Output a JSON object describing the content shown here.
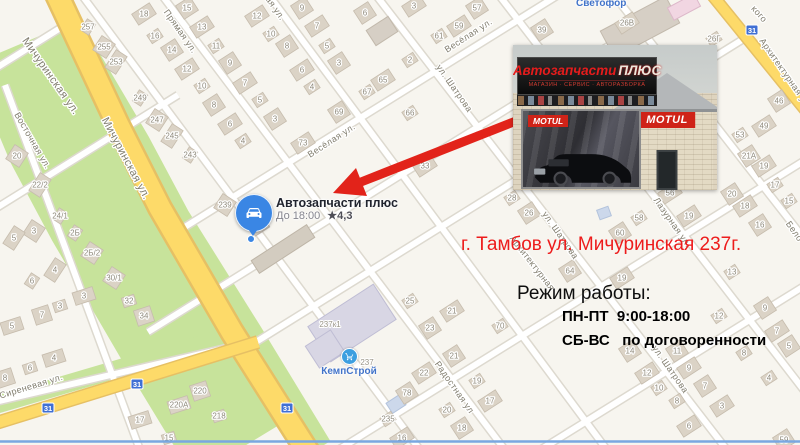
{
  "map": {
    "pin": {
      "title": "Автозапчасти плюс",
      "hours": "До 18:00",
      "rating": "★4,3"
    },
    "poi": {
      "svetofor": "Светофор",
      "kempstroy": "КемпСтрой"
    },
    "colors": {
      "road_yellow": "#fdda69",
      "green": "#c7e39b",
      "accent_red": "#e2231a",
      "poi_blue": "#4173c9",
      "pin_blue": "#3a86e4"
    },
    "street_labels": [
      {
        "t": "Мичуринская ул.",
        "x": 48,
        "y": 78,
        "r": 55,
        "s": 11
      },
      {
        "t": "Мичуринская ул.",
        "x": 123,
        "y": 160,
        "r": 62,
        "s": 11
      },
      {
        "t": "Восточная ул.",
        "x": 30,
        "y": 142,
        "r": 60,
        "s": 9
      },
      {
        "t": "Прямая ул.",
        "x": 178,
        "y": 33,
        "r": 55,
        "s": 9
      },
      {
        "t": "ая ул.",
        "x": 273,
        "y": 10,
        "r": 55,
        "s": 9
      },
      {
        "t": "Весёлая ул.",
        "x": 333,
        "y": 143,
        "r": -33,
        "s": 9
      },
      {
        "t": "Весёлая ул.",
        "x": 470,
        "y": 38,
        "r": -33,
        "s": 9
      },
      {
        "t": "ул. Шатрова",
        "x": 452,
        "y": 90,
        "r": 55,
        "s": 9
      },
      {
        "t": "ул. Шатрова",
        "x": 558,
        "y": 237,
        "r": 55,
        "s": 9
      },
      {
        "t": "ул. Шатрова",
        "x": 668,
        "y": 371,
        "r": 55,
        "s": 9
      },
      {
        "t": "Лазурная ул.",
        "x": 670,
        "y": 224,
        "r": 55,
        "s": 9
      },
      {
        "t": "Радостная ул",
        "x": 452,
        "y": 389,
        "r": 55,
        "s": 9
      },
      {
        "t": "Сиреневая ул.",
        "x": 32,
        "y": 389,
        "r": -17,
        "s": 9
      },
      {
        "t": "Архитектурная ул.",
        "x": 783,
        "y": 75,
        "r": 55,
        "s": 9
      },
      {
        "t": "Архитектурная",
        "x": 530,
        "y": 265,
        "r": 52,
        "s": 9
      },
      {
        "t": "Бело",
        "x": 792,
        "y": 233,
        "r": 55,
        "s": 9
      },
      {
        "t": "кого",
        "x": 757,
        "y": 16,
        "r": 48,
        "s": 9
      }
    ],
    "address_labels": [
      {
        "t": "237к1",
        "x": 330,
        "y": 327
      },
      {
        "t": "237",
        "x": 367,
        "y": 365
      }
    ],
    "route_badges": [
      {
        "t": "31",
        "x": 752,
        "y": 30
      },
      {
        "t": "31",
        "x": 137,
        "y": 384
      },
      {
        "t": "31",
        "x": 48,
        "y": 408
      },
      {
        "t": "31",
        "x": 287,
        "y": 408
      }
    ],
    "house_numbers": [
      {
        "t": "257",
        "x": 88,
        "y": 26,
        "r": -57
      },
      {
        "t": "255",
        "x": 104,
        "y": 46,
        "r": -57
      },
      {
        "t": "253",
        "x": 116,
        "y": 61,
        "r": -57
      },
      {
        "t": "249",
        "x": 140,
        "y": 97,
        "r": -57
      },
      {
        "t": "247",
        "x": 157,
        "y": 119,
        "r": -57
      },
      {
        "t": "245",
        "x": 172,
        "y": 135,
        "r": -57
      },
      {
        "t": "243",
        "x": 190,
        "y": 154,
        "r": -57
      },
      {
        "t": "239",
        "x": 225,
        "y": 204,
        "r": -57
      },
      {
        "t": "18",
        "x": 144,
        "y": 13
      },
      {
        "t": "16",
        "x": 155,
        "y": 35
      },
      {
        "t": "14",
        "x": 172,
        "y": 49
      },
      {
        "t": "12",
        "x": 187,
        "y": 68
      },
      {
        "t": "10",
        "x": 202,
        "y": 85
      },
      {
        "t": "8",
        "x": 214,
        "y": 104
      },
      {
        "t": "6",
        "x": 230,
        "y": 123
      },
      {
        "t": "4",
        "x": 243,
        "y": 140
      },
      {
        "t": "15",
        "x": 187,
        "y": 7
      },
      {
        "t": "13",
        "x": 202,
        "y": 26
      },
      {
        "t": "11",
        "x": 216,
        "y": 45
      },
      {
        "t": "9",
        "x": 230,
        "y": 62
      },
      {
        "t": "7",
        "x": 245,
        "y": 82
      },
      {
        "t": "5",
        "x": 260,
        "y": 99
      },
      {
        "t": "3",
        "x": 275,
        "y": 118
      },
      {
        "t": "12",
        "x": 257,
        "y": 15
      },
      {
        "t": "10",
        "x": 271,
        "y": 33
      },
      {
        "t": "8",
        "x": 287,
        "y": 45
      },
      {
        "t": "6",
        "x": 302,
        "y": 69
      },
      {
        "t": "4",
        "x": 312,
        "y": 86
      },
      {
        "t": "9",
        "x": 302,
        "y": 7
      },
      {
        "t": "7",
        "x": 317,
        "y": 25
      },
      {
        "t": "5",
        "x": 327,
        "y": 45
      },
      {
        "t": "3",
        "x": 339,
        "y": 62
      },
      {
        "t": "3",
        "x": 414,
        "y": 5
      },
      {
        "t": "2",
        "x": 410,
        "y": 59
      },
      {
        "t": "6",
        "x": 365,
        "y": 12
      },
      {
        "t": "65",
        "x": 383,
        "y": 79
      },
      {
        "t": "67",
        "x": 367,
        "y": 91
      },
      {
        "t": "69",
        "x": 339,
        "y": 111
      },
      {
        "t": "73",
        "x": 303,
        "y": 142
      },
      {
        "t": "66",
        "x": 410,
        "y": 112
      },
      {
        "t": "57",
        "x": 477,
        "y": 7
      },
      {
        "t": "59",
        "x": 459,
        "y": 25
      },
      {
        "t": "61",
        "x": 439,
        "y": 35
      },
      {
        "t": "39",
        "x": 542,
        "y": 29
      },
      {
        "t": "33",
        "x": 425,
        "y": 165
      },
      {
        "t": "28",
        "x": 512,
        "y": 197
      },
      {
        "t": "26",
        "x": 529,
        "y": 212
      },
      {
        "t": "26В",
        "x": 627,
        "y": 22
      },
      {
        "t": "26Г",
        "x": 714,
        "y": 38
      },
      {
        "t": "46",
        "x": 779,
        "y": 100
      },
      {
        "t": "49",
        "x": 764,
        "y": 125
      },
      {
        "t": "53",
        "x": 740,
        "y": 134
      },
      {
        "t": "21А",
        "x": 749,
        "y": 155
      },
      {
        "t": "19",
        "x": 764,
        "y": 165
      },
      {
        "t": "17",
        "x": 775,
        "y": 184
      },
      {
        "t": "20",
        "x": 732,
        "y": 193
      },
      {
        "t": "56",
        "x": 670,
        "y": 192
      },
      {
        "t": "58",
        "x": 639,
        "y": 217
      },
      {
        "t": "60",
        "x": 620,
        "y": 232
      },
      {
        "t": "18",
        "x": 745,
        "y": 205
      },
      {
        "t": "15",
        "x": 789,
        "y": 200
      },
      {
        "t": "16",
        "x": 760,
        "y": 224
      },
      {
        "t": "19",
        "x": 689,
        "y": 215
      },
      {
        "t": "13",
        "x": 732,
        "y": 271
      },
      {
        "t": "64",
        "x": 570,
        "y": 270
      },
      {
        "t": "19",
        "x": 622,
        "y": 277
      },
      {
        "t": "25",
        "x": 410,
        "y": 300
      },
      {
        "t": "23",
        "x": 430,
        "y": 327
      },
      {
        "t": "21",
        "x": 452,
        "y": 310
      },
      {
        "t": "70",
        "x": 500,
        "y": 325
      },
      {
        "t": "21",
        "x": 454,
        "y": 355
      },
      {
        "t": "22",
        "x": 424,
        "y": 372
      },
      {
        "t": "19",
        "x": 477,
        "y": 380
      },
      {
        "t": "78",
        "x": 407,
        "y": 392
      },
      {
        "t": "17",
        "x": 490,
        "y": 400
      },
      {
        "t": "20",
        "x": 447,
        "y": 409
      },
      {
        "t": "18",
        "x": 462,
        "y": 427
      },
      {
        "t": "16",
        "x": 402,
        "y": 437
      },
      {
        "t": "235",
        "x": 388,
        "y": 418
      },
      {
        "t": "14",
        "x": 630,
        "y": 350
      },
      {
        "t": "12",
        "x": 647,
        "y": 372
      },
      {
        "t": "10",
        "x": 659,
        "y": 387
      },
      {
        "t": "11",
        "x": 677,
        "y": 350
      },
      {
        "t": "9",
        "x": 689,
        "y": 367
      },
      {
        "t": "8",
        "x": 677,
        "y": 400
      },
      {
        "t": "7",
        "x": 705,
        "y": 385
      },
      {
        "t": "6",
        "x": 689,
        "y": 425
      },
      {
        "t": "12",
        "x": 719,
        "y": 315
      },
      {
        "t": "9",
        "x": 765,
        "y": 307
      },
      {
        "t": "7",
        "x": 777,
        "y": 330
      },
      {
        "t": "8",
        "x": 744,
        "y": 352
      },
      {
        "t": "5",
        "x": 789,
        "y": 345
      },
      {
        "t": "3",
        "x": 722,
        "y": 405
      },
      {
        "t": "4",
        "x": 769,
        "y": 377
      },
      {
        "t": "59",
        "x": 784,
        "y": 439
      },
      {
        "t": "3",
        "x": 84,
        "y": 295,
        "r": -18
      },
      {
        "t": "3",
        "x": 60,
        "y": 305,
        "r": -18
      },
      {
        "t": "7",
        "x": 42,
        "y": 314,
        "r": -18
      },
      {
        "t": "5",
        "x": 12,
        "y": 325,
        "r": -18
      },
      {
        "t": "32",
        "x": 129,
        "y": 300,
        "r": -18
      },
      {
        "t": "34",
        "x": 144,
        "y": 315,
        "r": -18
      },
      {
        "t": "4",
        "x": 54,
        "y": 357,
        "r": -18
      },
      {
        "t": "6",
        "x": 30,
        "y": 367,
        "r": -18
      },
      {
        "t": "8",
        "x": 5,
        "y": 377,
        "r": -18
      },
      {
        "t": "17",
        "x": 140,
        "y": 419,
        "r": -18
      },
      {
        "t": "15",
        "x": 169,
        "y": 437,
        "r": -18
      },
      {
        "t": "220",
        "x": 200,
        "y": 390,
        "r": -18
      },
      {
        "t": "220А",
        "x": 179,
        "y": 404,
        "r": -18
      },
      {
        "t": "218",
        "x": 219,
        "y": 415,
        "r": -18
      },
      {
        "t": "20",
        "x": 17,
        "y": 155,
        "r": -57
      },
      {
        "t": "22/2",
        "x": 40,
        "y": 184,
        "r": -57
      },
      {
        "t": "24/1",
        "x": 60,
        "y": 215,
        "r": -57
      },
      {
        "t": "3",
        "x": 34,
        "y": 230,
        "r": -57
      },
      {
        "t": "5",
        "x": 14,
        "y": 237,
        "r": -57
      },
      {
        "t": "2Б",
        "x": 75,
        "y": 232,
        "r": -57
      },
      {
        "t": "2Б/2",
        "x": 92,
        "y": 252,
        "r": -57
      },
      {
        "t": "4",
        "x": 55,
        "y": 269,
        "r": -57
      },
      {
        "t": "6",
        "x": 32,
        "y": 280,
        "r": -57
      },
      {
        "t": "30/1",
        "x": 114,
        "y": 277,
        "r": -57
      }
    ]
  },
  "photo": {
    "sign_title_red": "Автозапчасти",
    "sign_title_accent": "ПЛЮС",
    "sign_subtitle": "МАГАЗИН · СЕРВИС · АВТОРАЗБОРКА",
    "banner_brand": "MOTUL",
    "wall_brand": "MOTUL"
  },
  "annotations": {
    "address": "г. Тамбов ул. Мичуринская 237г.",
    "schedule_title": "Режим работы:",
    "schedule_line1": "ПН-ПТ  9:00-18:00",
    "schedule_line2": "СБ-ВС   по договоренности"
  }
}
